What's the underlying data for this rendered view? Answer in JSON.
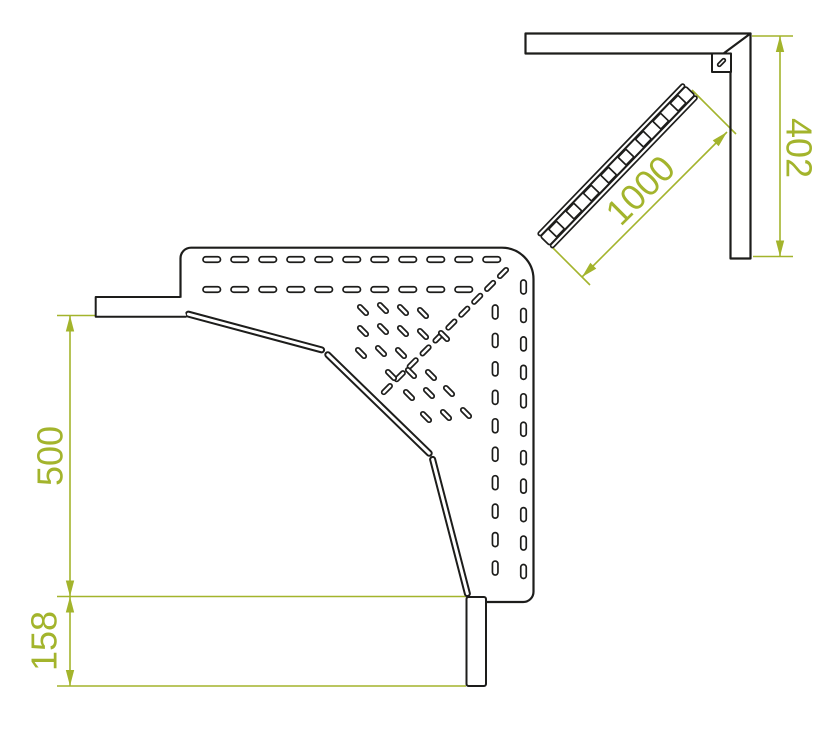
{
  "colors": {
    "line": "#1d1d1b",
    "dimension": "#a3b42c",
    "background": "#ffffff"
  },
  "dims": {
    "d500": "500",
    "d158": "158",
    "d1000": "1000",
    "d402": "402"
  }
}
